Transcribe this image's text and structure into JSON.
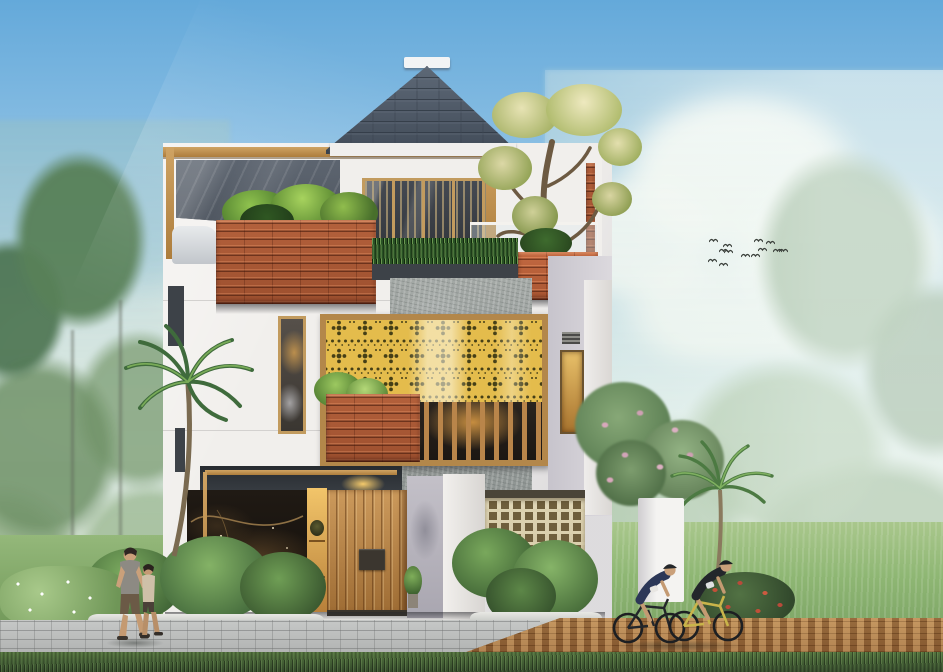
{
  "scene": {
    "type": "architectural-exterior-rendering",
    "subject": "modern tropical three-storey house with rooftop terrace",
    "time_of_day": "day",
    "weather": "sunny with soft clouds and mist",
    "house": {
      "storeys": 3,
      "features": [
        "pyramidal slate hip roof with white ridge cap",
        "rooftop pergola and grey shed roof",
        "timber plank planter boxes with tropical plants",
        "frangipani bonsai tree on roof terrace",
        "gold perforated ornamental screen",
        "timber baluster window band",
        "black marble feature wall with gold veins",
        "vertical timber slat entry door with dark square plate",
        "cream breeze-block lattice wall",
        "glass balustrade with grass hedge ledge"
      ]
    },
    "people": {
      "pedestrians": 2,
      "cyclists": 2
    },
    "birds": {
      "count": 13,
      "positions": [
        [
          709,
          228
        ],
        [
          723,
          233
        ],
        [
          719,
          238
        ],
        [
          708,
          248
        ],
        [
          724,
          239
        ],
        [
          741,
          243
        ],
        [
          754,
          228
        ],
        [
          758,
          237
        ],
        [
          766,
          230
        ],
        [
          773,
          238
        ],
        [
          779,
          238
        ],
        [
          751,
          243
        ],
        [
          719,
          252
        ]
      ]
    },
    "palette": {
      "sky_top": "#64a9da",
      "sky_mid": "#9ecae8",
      "sky_low": "#ddeef5",
      "grass_field": "#8fb774",
      "grass_dark": "#46633a",
      "roof_slate": "#4b5563",
      "wood_frame": "#c29b5e",
      "plank_wood": "#ad5c38",
      "gold_screen": "#e4bc4c",
      "gold_motif": "#453f16",
      "concrete": "#9ba19f",
      "wall_white": "#f1efec",
      "accent_dark": "#3d4248",
      "marble_black": "#161210",
      "door_wood": "#bf8c50",
      "breeze_cream": "#dbd0ae",
      "breeze_hole": "#6f5e3c",
      "path_gray": "#b5b7b6",
      "path_brown": "#a87a4a"
    }
  }
}
